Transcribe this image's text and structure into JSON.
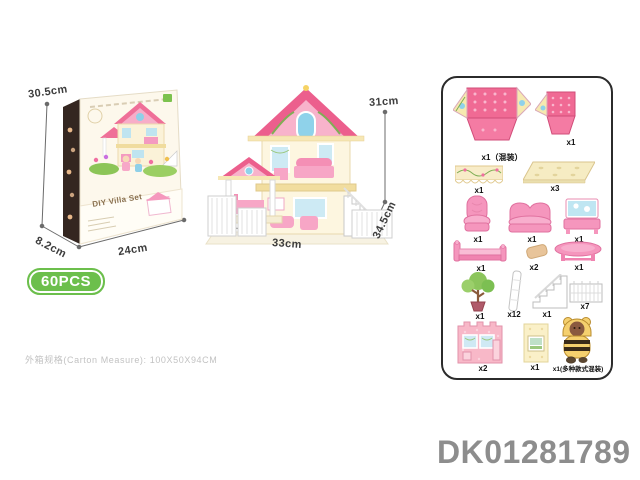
{
  "box": {
    "badge": "60PCS",
    "title": "DIY Villa Set",
    "dims": {
      "height": "30.5cm",
      "width": "24cm",
      "depth": "8.2cm"
    }
  },
  "house": {
    "dims": {
      "height": "31cm",
      "width": "33cm",
      "depth": "34.5cm"
    }
  },
  "parts": {
    "items": [
      {
        "name": "roof-panel-unfolded",
        "qty": "x1（混装）"
      },
      {
        "name": "roof-panel-folded",
        "qty": "x1"
      },
      {
        "name": "awning-panel",
        "qty": "x1"
      },
      {
        "name": "floor-panel",
        "qty": "x3"
      },
      {
        "name": "armchair",
        "qty": "x1"
      },
      {
        "name": "sofa",
        "qty": "x1"
      },
      {
        "name": "vanity-dresser",
        "qty": "x1"
      },
      {
        "name": "bed",
        "qty": "x1"
      },
      {
        "name": "pillow",
        "qty": "x2"
      },
      {
        "name": "table",
        "qty": "x1"
      },
      {
        "name": "tree",
        "qty": "x1"
      },
      {
        "name": "column",
        "qty": "x12"
      },
      {
        "name": "staircase",
        "qty": "x1"
      },
      {
        "name": "fence",
        "qty": "x7"
      },
      {
        "name": "wall-panel-pink",
        "qty": "x2"
      },
      {
        "name": "wall-panel-yellow",
        "qty": "x1"
      },
      {
        "name": "doll",
        "qty": "x1(多种款式混装)"
      }
    ]
  },
  "footer": {
    "carton_note": "外箱规格(Carton Measure): 100X50X94CM",
    "product_code": "DK01281789"
  },
  "colors": {
    "badge_green": "#6cbf4c",
    "roof_pink": "#ec5f8d",
    "panel_pink": "#f59ab8",
    "cream": "#f8eec9",
    "furniture_pink": "#f596bd",
    "code_gray": "#8d8d8d"
  }
}
